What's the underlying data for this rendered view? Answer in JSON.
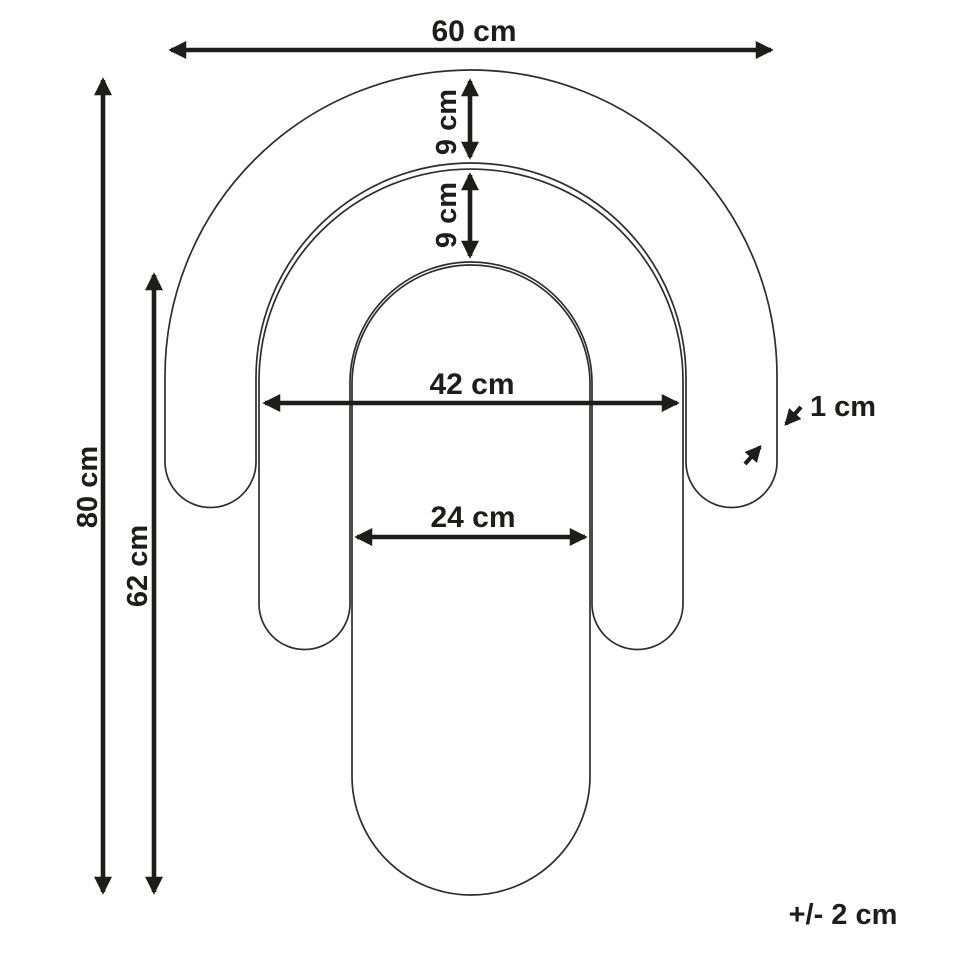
{
  "figure": {
    "kind": "product-dimension-diagram",
    "unit": "cm",
    "background_color": "#ffffff",
    "outline_color": "#2d2d2b",
    "dimension_color": "#1d1d1b",
    "shapes": [
      {
        "name": "outer-arch",
        "width_cm": 60,
        "band_thickness_cm": 9
      },
      {
        "name": "middle-arch",
        "width_cm": 42,
        "band_thickness_cm": 9
      },
      {
        "name": "inner-pill",
        "width_cm": 24,
        "height_cm": 62
      }
    ]
  },
  "dimensions": {
    "outer_width": {
      "label": "60 cm",
      "value_cm": 60
    },
    "outer_band": {
      "label": "9 cm",
      "value_cm": 9
    },
    "middle_band": {
      "label": "9 cm",
      "value_cm": 9
    },
    "overall_height": {
      "label": "80 cm",
      "value_cm": 80
    },
    "pill_height": {
      "label": "62 cm",
      "value_cm": 62
    },
    "middle_width": {
      "label": "42 cm",
      "value_cm": 42
    },
    "pill_width": {
      "label": "24 cm",
      "value_cm": 24
    },
    "thickness": {
      "label": "1 cm",
      "value_cm": 1
    },
    "tolerance": {
      "label": "+/- 2 cm",
      "value_cm": 2
    }
  }
}
